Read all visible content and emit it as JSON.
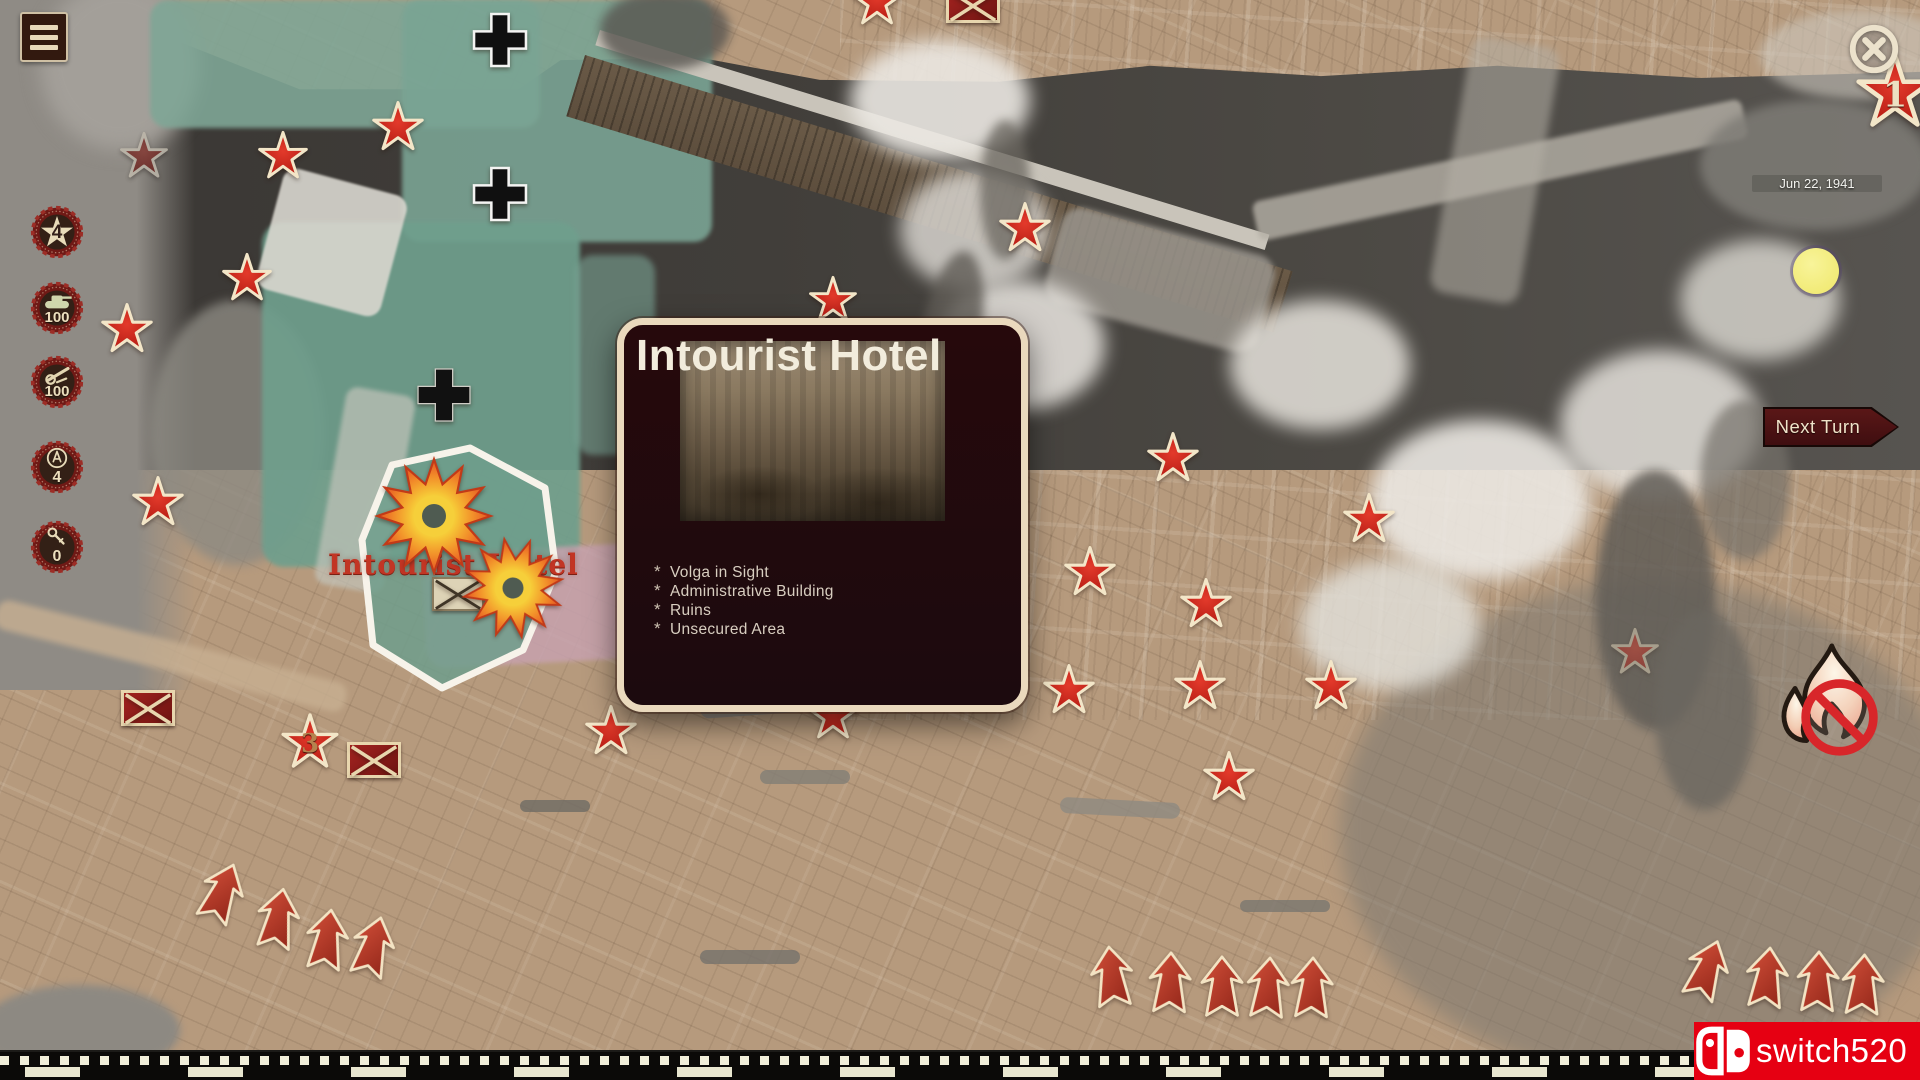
{
  "menu": {
    "icon": "hamburger-menu-icon"
  },
  "resources": [
    {
      "name": "rank",
      "icon": "rank-star-icon",
      "value": "4"
    },
    {
      "name": "infantry",
      "icon": "tank-icon",
      "value": "100"
    },
    {
      "name": "artillery",
      "icon": "artillery-gun-icon",
      "value": "100"
    },
    {
      "name": "abilities",
      "icon": "ability-circle-icon",
      "value": "4"
    },
    {
      "name": "keys",
      "icon": "key-icon",
      "value": "0"
    }
  ],
  "hud": {
    "date": "Jun 22, 1941",
    "next_turn_label": "Next Turn",
    "close_icon": "close-icon",
    "ceasefire_icon": "no-fire-icon",
    "event_marker": "yellow-event-marker"
  },
  "popup": {
    "title": "Intourist Hotel",
    "features": [
      "Volga in Sight",
      "Administrative Building",
      "Ruins",
      "Unsecured Area"
    ]
  },
  "map": {
    "location_label": "Intourist Hotel",
    "markers": {
      "soviet_stars": [
        {
          "x": 144,
          "y": 156,
          "size": 52,
          "style": "dim"
        },
        {
          "x": 283,
          "y": 156,
          "size": 54
        },
        {
          "x": 398,
          "y": 127,
          "size": 56
        },
        {
          "x": 247,
          "y": 278,
          "size": 54
        },
        {
          "x": 127,
          "y": 329,
          "size": 56
        },
        {
          "x": 158,
          "y": 502,
          "size": 56
        },
        {
          "x": 310,
          "y": 742,
          "size": 62,
          "label": "3"
        },
        {
          "x": 611,
          "y": 731,
          "size": 56
        },
        {
          "x": 877,
          "y": 2,
          "size": 54
        },
        {
          "x": 1025,
          "y": 228,
          "size": 56
        },
        {
          "x": 833,
          "y": 300,
          "size": 52
        },
        {
          "x": 1173,
          "y": 458,
          "size": 56
        },
        {
          "x": 1369,
          "y": 519,
          "size": 56
        },
        {
          "x": 1090,
          "y": 572,
          "size": 56
        },
        {
          "x": 1206,
          "y": 604,
          "size": 56
        },
        {
          "x": 1069,
          "y": 690,
          "size": 56
        },
        {
          "x": 1200,
          "y": 686,
          "size": 56
        },
        {
          "x": 1331,
          "y": 686,
          "size": 56
        },
        {
          "x": 1229,
          "y": 777,
          "size": 56
        },
        {
          "x": 833,
          "y": 716,
          "size": 54
        },
        {
          "x": 1635,
          "y": 652,
          "size": 52,
          "style": "ghost"
        },
        {
          "x": 1895,
          "y": 92,
          "size": 84,
          "label": "1",
          "label_style": "light"
        }
      ],
      "destroyed_units": [
        {
          "x": 148,
          "y": 708
        },
        {
          "x": 374,
          "y": 760
        },
        {
          "x": 973,
          "y": 5
        }
      ],
      "captured_objective": {
        "x": 458,
        "y": 594
      },
      "german_crosses": [
        {
          "x": 500,
          "y": 40,
          "variant": "outlined"
        },
        {
          "x": 500,
          "y": 194,
          "variant": "outlined"
        },
        {
          "x": 444,
          "y": 395,
          "variant": "plain"
        }
      ],
      "explosions": [
        {
          "x": 434,
          "y": 516,
          "size": 120,
          "rot": 0
        },
        {
          "x": 513,
          "y": 588,
          "size": 105,
          "rot": 20
        }
      ],
      "assault_arrows": [
        {
          "x": 222,
          "y": 893,
          "rot": 22
        },
        {
          "x": 278,
          "y": 919,
          "rot": 10
        },
        {
          "x": 327,
          "y": 940,
          "rot": 8
        },
        {
          "x": 373,
          "y": 947,
          "rot": 15
        },
        {
          "x": 1112,
          "y": 977,
          "rot": -6
        },
        {
          "x": 1170,
          "y": 983,
          "rot": 2
        },
        {
          "x": 1222,
          "y": 987,
          "rot": 0
        },
        {
          "x": 1268,
          "y": 988,
          "rot": 4
        },
        {
          "x": 1312,
          "y": 988,
          "rot": 2
        },
        {
          "x": 1707,
          "y": 970,
          "rot": 20
        },
        {
          "x": 1767,
          "y": 978,
          "rot": 6
        },
        {
          "x": 1818,
          "y": 982,
          "rot": 2
        },
        {
          "x": 1863,
          "y": 985,
          "rot": 3
        }
      ]
    }
  },
  "watermark": {
    "text": "switch520",
    "logo": "nintendo-switch-icon"
  }
}
